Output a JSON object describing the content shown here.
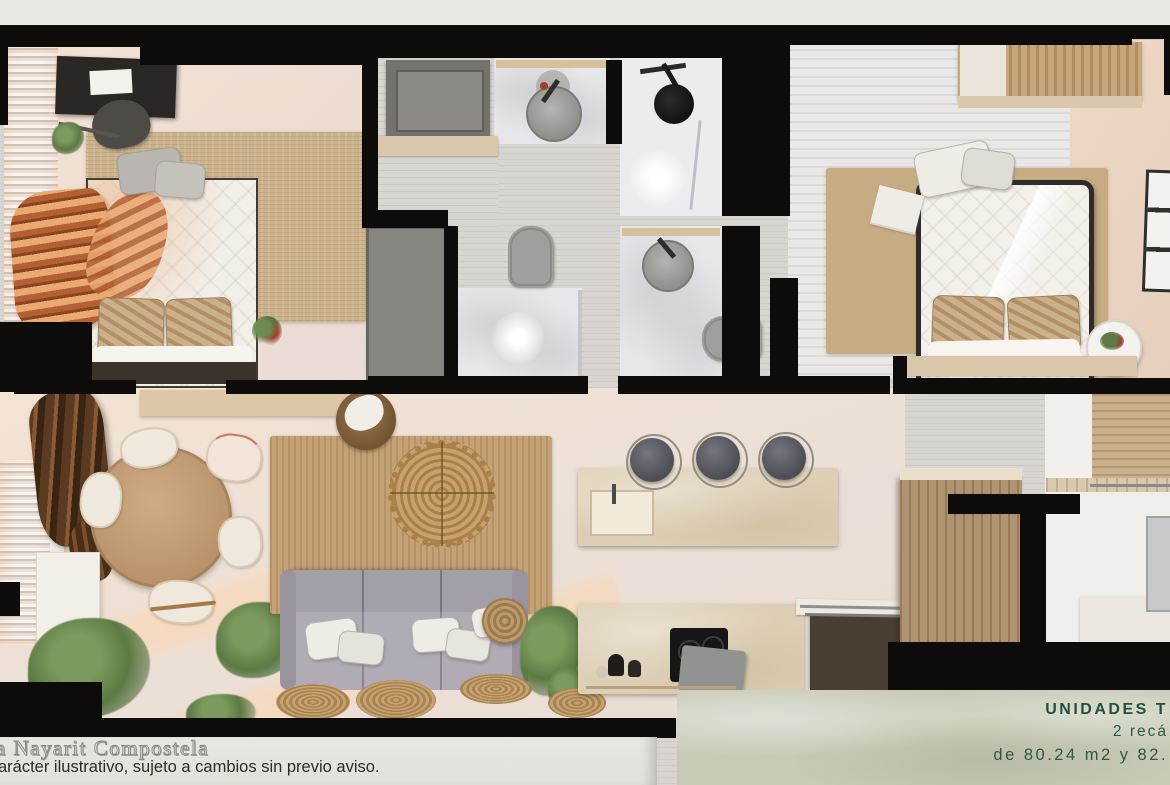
{
  "page": {
    "background": "#eae7e2"
  },
  "colors": {
    "wall": "#0d0c0a",
    "info_box_background": "#c7cab6",
    "info_box_text": "#2d5847",
    "jute_rug": "#cbb28c",
    "sofa": "#aaa5ae",
    "counter": "#ddcfb5"
  },
  "footer": {
    "line1": "a Nayarit Compostela",
    "line2": "arácter ilustrativo, sujeto a cambios sin previo aviso."
  },
  "info_box": {
    "title": "UNIDADES T",
    "line2": "2 recá",
    "line3": "de 80.24 m2 y 82."
  }
}
